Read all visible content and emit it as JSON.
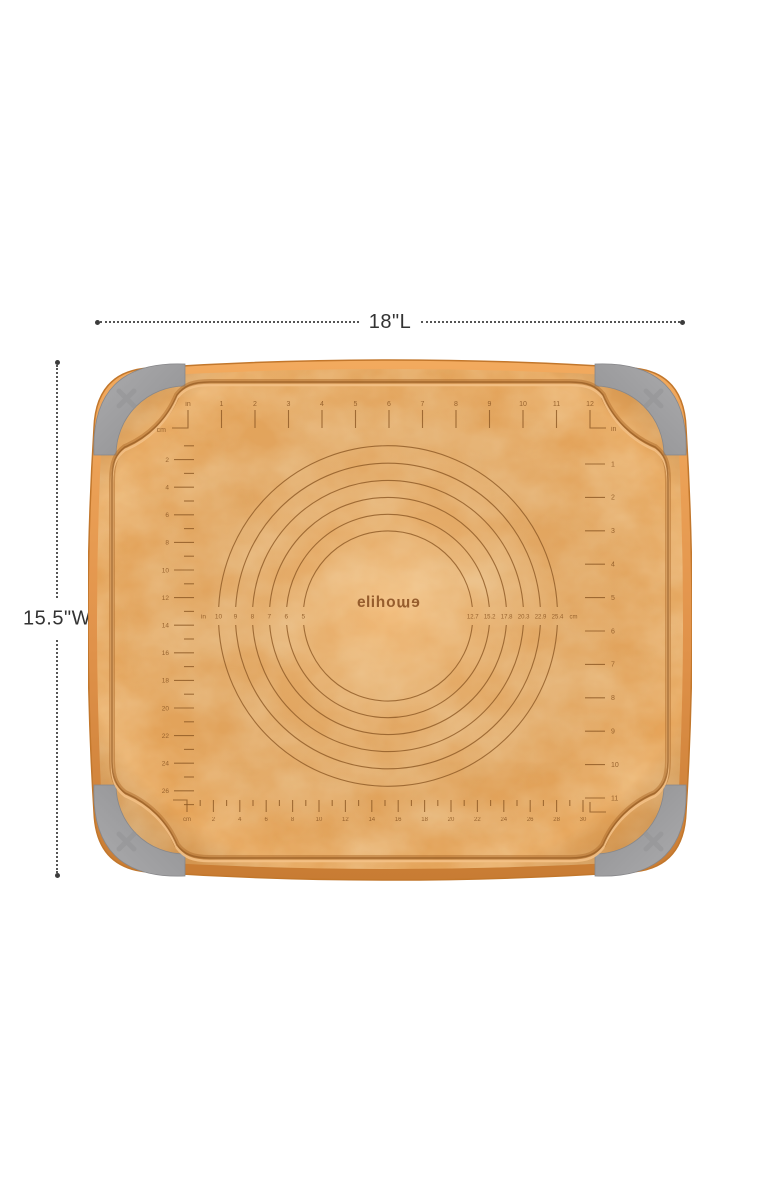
{
  "dimensions": {
    "length_label": "18\"L",
    "width_label": "15.5\"W"
  },
  "brand_logo": {
    "full_text": "elihome",
    "prefix": "eli",
    "mirror_part": "home"
  },
  "board_rulers": {
    "top_inches": {
      "origin_unit": "in",
      "tick_numbers": [
        1,
        2,
        3,
        4,
        5,
        6,
        7,
        8,
        9,
        10,
        11
      ],
      "end_number": 12,
      "end_unit": "in"
    },
    "left_cm": {
      "unit": "cm",
      "tick_numbers": [
        2,
        4,
        6,
        8,
        10,
        12,
        14,
        16,
        18,
        20,
        22,
        24,
        26
      ]
    },
    "bottom_cm": {
      "unit": "cm",
      "tick_numbers": [
        2,
        4,
        6,
        8,
        10,
        12,
        14,
        16,
        18,
        20,
        22,
        24,
        26,
        28,
        30
      ]
    },
    "right_inches": {
      "tick_numbers": [
        1,
        2,
        3,
        4,
        5,
        6,
        7,
        8,
        9,
        10,
        11
      ]
    }
  },
  "rolling_circles": {
    "unit_in": "in",
    "unit_cm": "cm",
    "inch_diameter_labels": [
      "10",
      "9",
      "8",
      "7",
      "6",
      "5"
    ],
    "cm_diameter_labels": [
      "12.7",
      "15.2",
      "17.8",
      "20.3",
      "22.9",
      "25.4"
    ],
    "diameters_inches": [
      10,
      9,
      8,
      7,
      6,
      5
    ]
  },
  "colors": {
    "board_surface": "#E9A65D",
    "board_rim": "#DE9145",
    "marking_brown": "#8F5A26",
    "grip_gray": "#9D9D9F",
    "dimension_gray": "#3C3C3C",
    "background": "#FFFFFF"
  }
}
